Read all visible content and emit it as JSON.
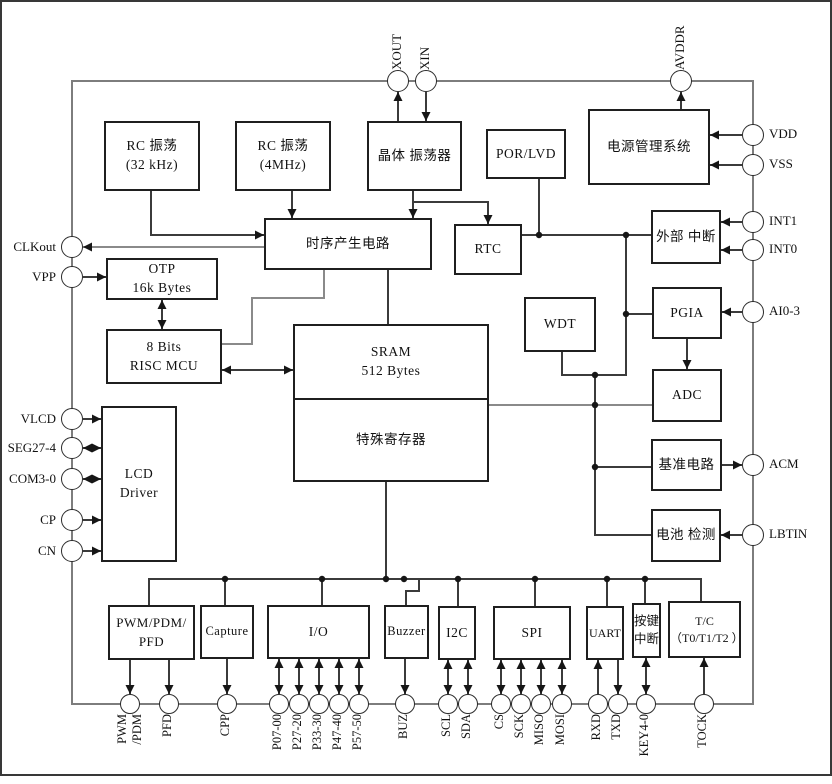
{
  "palette": {
    "background": "#ffffff",
    "block_border": "#1f1f1f",
    "chip_border": "#7d7d7d",
    "wire": "#3b3b3b",
    "wire_gray": "#8a8a8a",
    "text": "#111111"
  },
  "chip": {
    "blocks": {
      "rc32k": {
        "label": "RC 振荡\n(32 kHz)"
      },
      "rc4m": {
        "label": "RC 振荡\n(4MHz)"
      },
      "xtal": {
        "label": "晶体 振荡器"
      },
      "porlvd": {
        "label": "POR/LVD"
      },
      "pwr": {
        "label": "电源管理系统"
      },
      "timing": {
        "label": "时序产生电路"
      },
      "rtc": {
        "label": "RTC"
      },
      "extint": {
        "label": "外部 中断"
      },
      "otp": {
        "label": "OTP\n16k Bytes"
      },
      "pgia": {
        "label": "PGIA"
      },
      "mcu": {
        "label": "8 Bits\nRISC MCU"
      },
      "wdt": {
        "label": "WDT"
      },
      "sram": {
        "label": "SRAM\n512 Bytes"
      },
      "sfr": {
        "label": "特殊寄存器"
      },
      "adc": {
        "label": "ADC"
      },
      "vref": {
        "label": "基准电路"
      },
      "batt": {
        "label": "电池 检测"
      },
      "lcd": {
        "label": "LCD\nDriver"
      },
      "pwm": {
        "label": "PWM/PDM/\nPFD"
      },
      "capture": {
        "label": "Capture"
      },
      "io": {
        "label": "I/O"
      },
      "buzzer": {
        "label": "Buzzer"
      },
      "i2c": {
        "label": "I2C"
      },
      "spi": {
        "label": "SPI"
      },
      "uart": {
        "label": "UART"
      },
      "keyint": {
        "label": "按键\n中断"
      },
      "tc": {
        "label": "T/C\n（T0/T1/T2 ）"
      }
    },
    "pins": {
      "top": [
        {
          "label": "XOUT"
        },
        {
          "label": "XIN"
        },
        {
          "label": "AVDDR"
        }
      ],
      "right": [
        {
          "label": "VDD"
        },
        {
          "label": "VSS"
        },
        {
          "label": "INT1"
        },
        {
          "label": "INT0"
        },
        {
          "label": "AI0-3"
        },
        {
          "label": "ACM"
        },
        {
          "label": "LBTIN"
        }
      ],
      "left": [
        {
          "label": "CLKout"
        },
        {
          "label": "VPP"
        },
        {
          "label": "VLCD"
        },
        {
          "label": "SEG27-4"
        },
        {
          "label": "COM3-0"
        },
        {
          "label": "CP"
        },
        {
          "label": "CN"
        }
      ],
      "bottom": [
        {
          "label": "PWM\n/PDM"
        },
        {
          "label": "PFD"
        },
        {
          "label": "CPP"
        },
        {
          "label": "P07-00"
        },
        {
          "label": "P27-20"
        },
        {
          "label": "P33-30"
        },
        {
          "label": "P47-40"
        },
        {
          "label": "P57-50"
        },
        {
          "label": "BUZ"
        },
        {
          "label": "SCL"
        },
        {
          "label": "SDA"
        },
        {
          "label": "CS"
        },
        {
          "label": "SCK"
        },
        {
          "label": "MISO"
        },
        {
          "label": "MOSI"
        },
        {
          "label": "RXD"
        },
        {
          "label": "TXD"
        },
        {
          "label": "KEY4-0"
        },
        {
          "label": "TOCK"
        }
      ]
    }
  }
}
